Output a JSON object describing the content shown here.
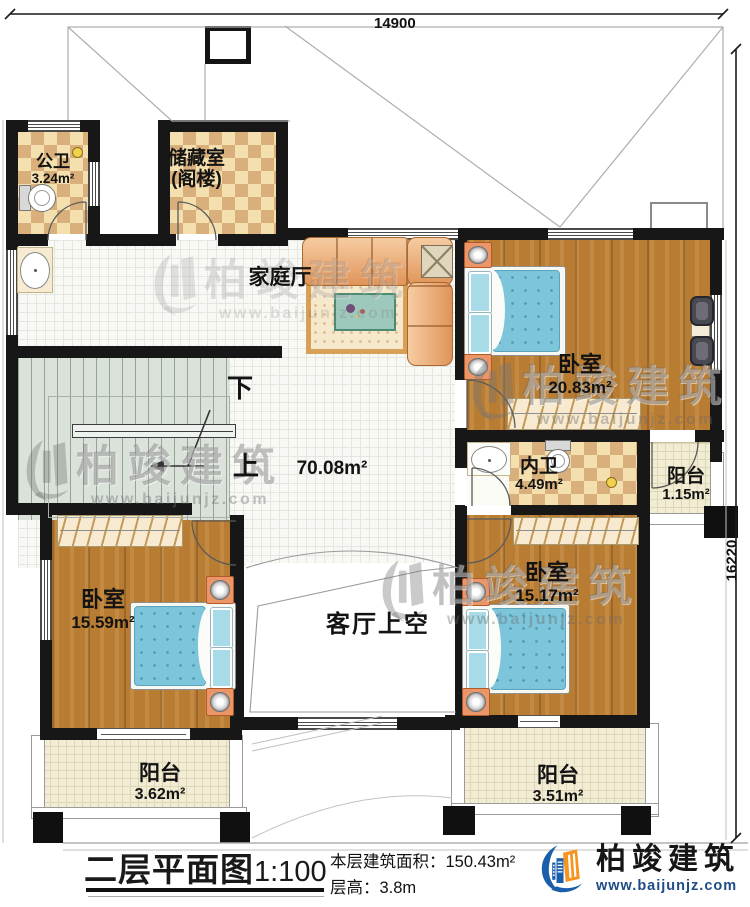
{
  "plan": {
    "title": "二层平面图",
    "scale": "1:100",
    "dims": {
      "width_mm": "14900",
      "height_mm": "16220"
    },
    "rooms": [
      {
        "name": "公卫",
        "area": "3.24m²"
      },
      {
        "name": "储藏室",
        "sub": "(阁楼)"
      },
      {
        "name": "家庭厅",
        "area": "70.08m²"
      },
      {
        "name": "卧室",
        "area": "20.83m²"
      },
      {
        "name": "内卫",
        "area": "4.49m²"
      },
      {
        "name": "阳台",
        "area": "1.15m²"
      },
      {
        "name": "卧室",
        "area": "15.59m²"
      },
      {
        "name": "卧室",
        "area": "15.17m²"
      },
      {
        "name": "客厅上空"
      },
      {
        "name": "阳台",
        "area": "3.62m²"
      },
      {
        "name": "阳台",
        "area": "3.51m²"
      }
    ],
    "stairs": {
      "down_label": "下",
      "up_label": "上"
    }
  },
  "footer": {
    "area_label": "本层建筑面积：",
    "area_value": "150.43m²",
    "height_label": "层高：",
    "height_value": "3.8m"
  },
  "logo": {
    "name": "柏竣建筑",
    "url": "www.baijunjz.com"
  },
  "watermark": {
    "text": "柏竣建筑",
    "url": "www.baijunjz.com"
  },
  "colors": {
    "wall": "#171717",
    "accent_blue": "#1b5ea9",
    "accent_orange": "#f7941e"
  }
}
